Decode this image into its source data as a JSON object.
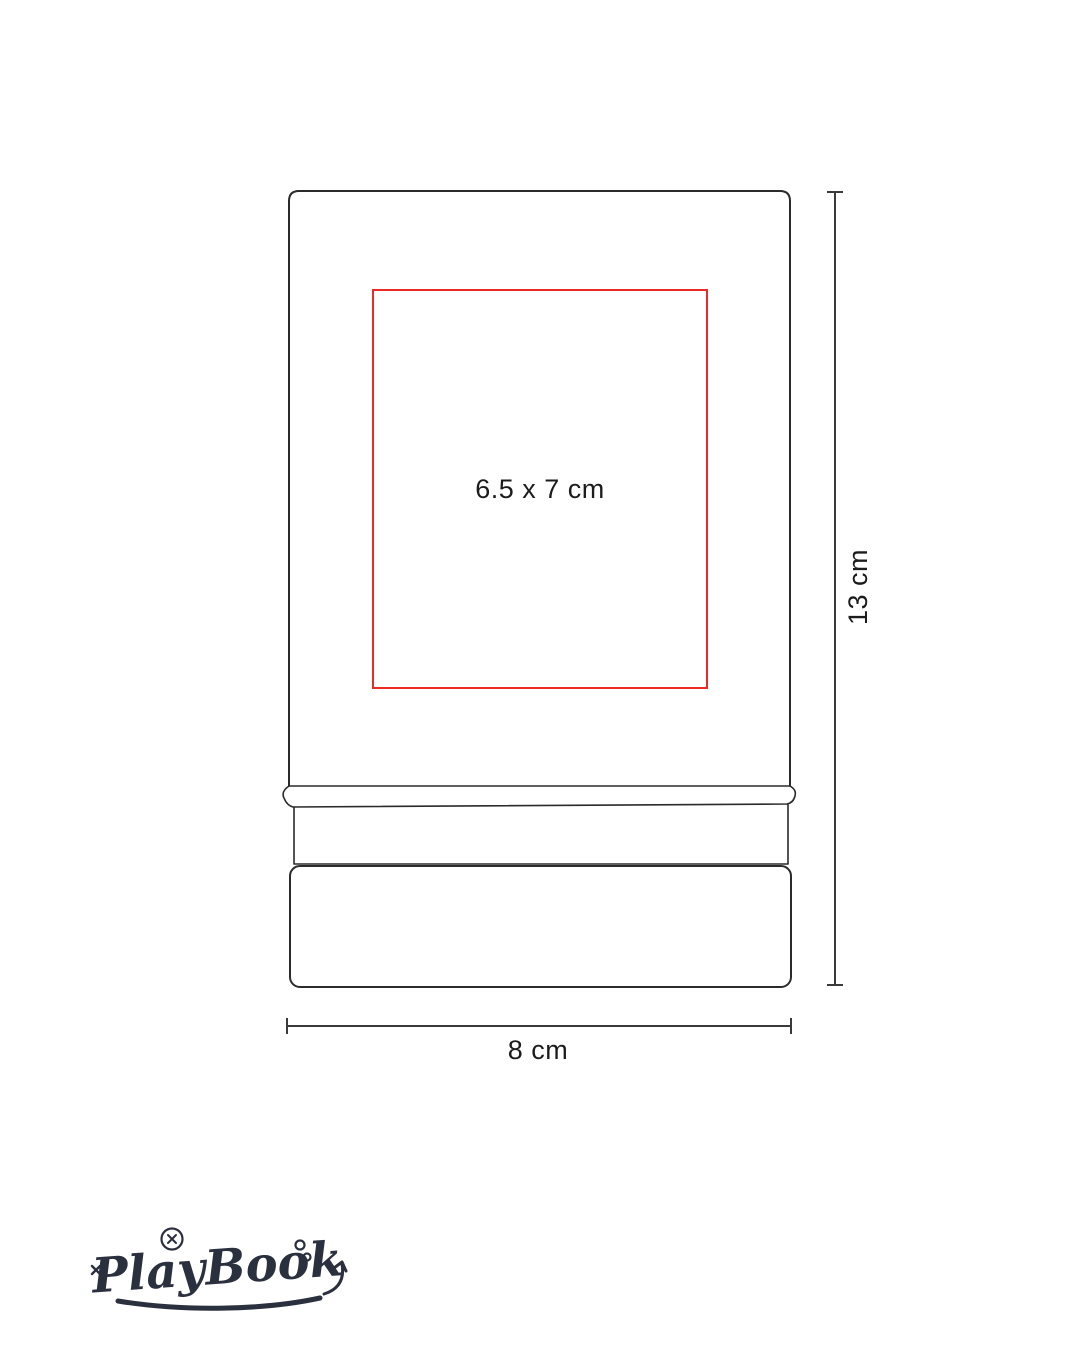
{
  "colors": {
    "background": "#ffffff",
    "outline": "#2b2b2b",
    "dimension_line": "#3a3a3a",
    "print_area": "#ed2a26",
    "label_text": "#1c1c1c",
    "logo": "#2b303f"
  },
  "product": {
    "print_area_label": "6.5 x 7 cm",
    "height_label": "13 cm",
    "width_label": "8 cm"
  },
  "logo": {
    "brand": "PlayBook"
  }
}
